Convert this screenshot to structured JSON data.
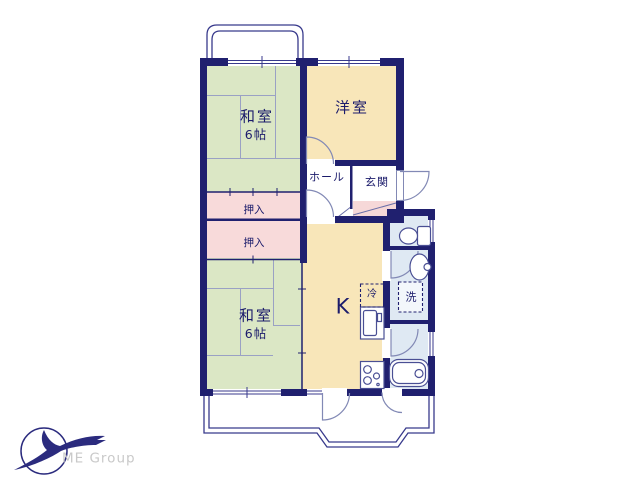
{
  "rooms": {
    "washitsu_top": {
      "label": "和室",
      "size": "6帖"
    },
    "yoshitsu": {
      "label": "洋室"
    },
    "hall": {
      "label": "ホール"
    },
    "genkan": {
      "label": "玄関"
    },
    "closet_top": {
      "label": "押入"
    },
    "closet_bottom": {
      "label": "押入"
    },
    "washitsu_bottom": {
      "label": "和室",
      "size": "6帖"
    },
    "kitchen": {
      "label": "K"
    },
    "fridge": {
      "label": "冷"
    },
    "laundry": {
      "label": "洗"
    }
  },
  "branding": {
    "company": "ME Group"
  },
  "colors": {
    "wall": "#20206f",
    "tatami_green": "#dbe7c5",
    "western_beige": "#f8e6b9",
    "closet_pink": "#f8dada",
    "sanitary_blue": "#dfe9f3",
    "step_pink": "#f6d8d8",
    "tatami_line": "#9aa1c4",
    "door_line": "#8289b5",
    "fixture_line": "#4a4f94",
    "text": "#1b1b6b",
    "logo_text": "#c9c9c9"
  }
}
